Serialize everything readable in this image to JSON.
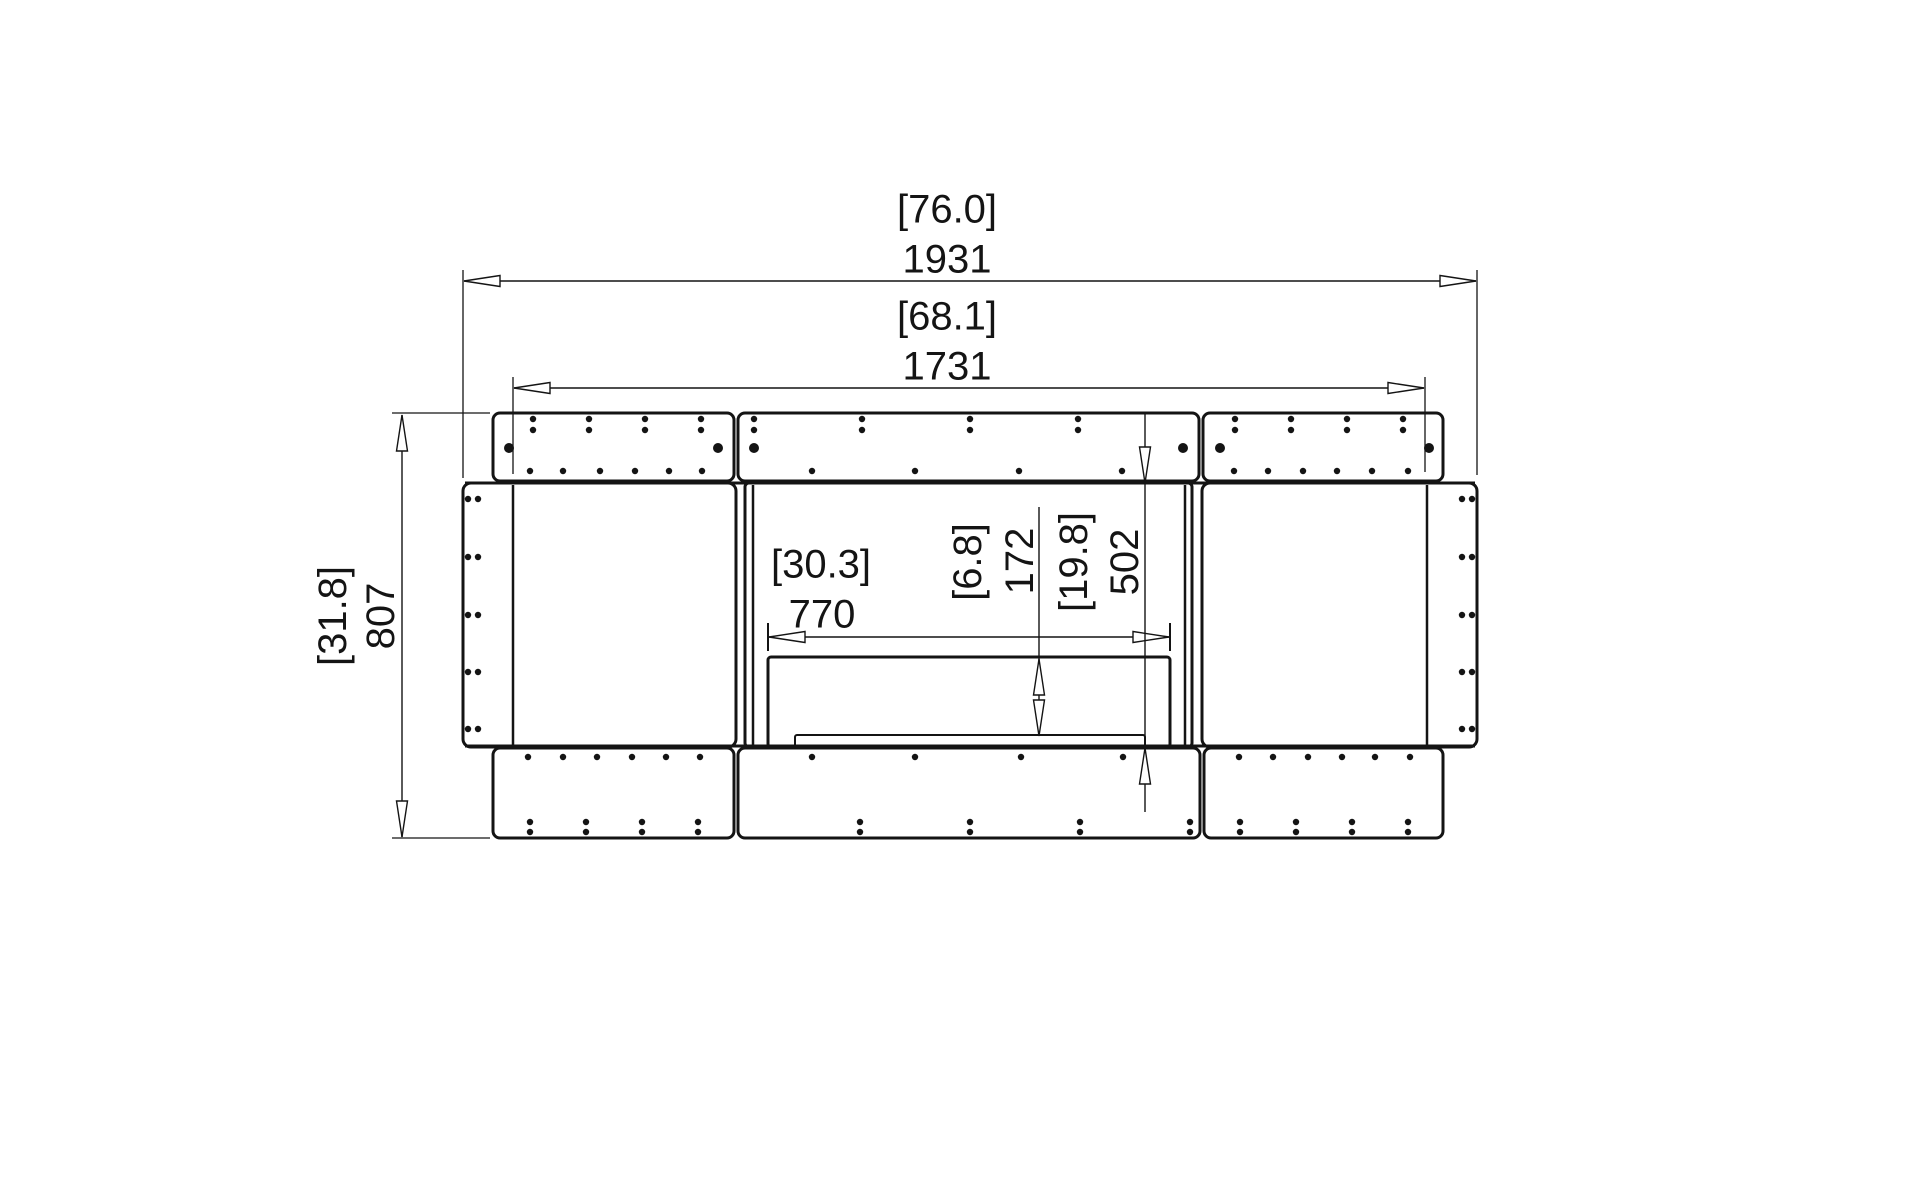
{
  "drawing": {
    "title": "fireplace-bench-front-elevation",
    "canvas": {
      "width": 1920,
      "height": 1187,
      "background": "#ffffff",
      "ink": "#141414"
    },
    "units_note_visible": false,
    "dimensions": [
      {
        "name": "overall-width",
        "inches": "[76.0]",
        "mm": "1931",
        "rotated": false,
        "line": {
          "x1": 464,
          "y1": 281,
          "x2": 1476,
          "y2": 281
        },
        "exts": [
          {
            "x1": 463,
            "y1": 270,
            "x2": 463,
            "y2": 478
          },
          {
            "x1": 1477,
            "y1": 270,
            "x2": 1477,
            "y2": 475
          }
        ],
        "ticks": [],
        "arrows": [
          {
            "x": 464,
            "y": 281,
            "dir": "left"
          },
          {
            "x": 1476,
            "y": 281,
            "dir": "right"
          }
        ],
        "labels": {
          "inches": {
            "x": 947,
            "y": 211
          },
          "mm": {
            "x": 947,
            "y": 261
          }
        }
      },
      {
        "name": "top-panel-width",
        "inches": "[68.1]",
        "mm": "1731",
        "rotated": false,
        "line": {
          "x1": 514,
          "y1": 388,
          "x2": 1424,
          "y2": 388
        },
        "exts": [
          {
            "x1": 513,
            "y1": 377,
            "x2": 513,
            "y2": 474
          },
          {
            "x1": 1425,
            "y1": 377,
            "x2": 1425,
            "y2": 472
          }
        ],
        "ticks": [],
        "arrows": [
          {
            "x": 514,
            "y": 388,
            "dir": "left"
          },
          {
            "x": 1424,
            "y": 388,
            "dir": "right"
          }
        ],
        "labels": {
          "inches": {
            "x": 947,
            "y": 318
          },
          "mm": {
            "x": 947,
            "y": 368
          }
        }
      },
      {
        "name": "overall-height",
        "inches": "[31.8]",
        "mm": "807",
        "rotated": true,
        "line": {
          "x1": 402,
          "y1": 415,
          "x2": 402,
          "y2": 837
        },
        "exts": [
          {
            "x1": 392,
            "y1": 413,
            "x2": 490,
            "y2": 413
          },
          {
            "x1": 392,
            "y1": 838,
            "x2": 490,
            "y2": 838
          }
        ],
        "ticks": [],
        "arrows": [
          {
            "x": 402,
            "y": 415,
            "dir": "up"
          },
          {
            "x": 402,
            "y": 837,
            "dir": "down"
          }
        ],
        "labels": {
          "inches": {
            "x": 333,
            "y": 616
          },
          "mm": {
            "x": 381,
            "y": 616
          }
        }
      },
      {
        "name": "burner-width",
        "inches": "[30.3]",
        "mm": "770",
        "rotated": false,
        "line": {
          "x1": 769,
          "y1": 637,
          "x2": 1169,
          "y2": 637
        },
        "exts": [],
        "ticks": [
          {
            "x1": 768,
            "y1": 623,
            "x2": 768,
            "y2": 651
          },
          {
            "x1": 1170,
            "y1": 623,
            "x2": 1170,
            "y2": 651
          }
        ],
        "arrows": [
          {
            "x": 769,
            "y": 637,
            "dir": "left"
          },
          {
            "x": 1169,
            "y": 637,
            "dir": "right"
          }
        ],
        "labels": {
          "inches": {
            "x": 821,
            "y": 566
          },
          "mm": {
            "x": 822,
            "y": 616
          }
        }
      },
      {
        "name": "burner-height",
        "inches": "[6.8]",
        "mm": "172",
        "rotated": true,
        "line": {
          "x1": 1039,
          "y1": 507,
          "x2": 1039,
          "y2": 736
        },
        "exts": [],
        "ticks": [],
        "arrows": [
          {
            "x": 1039,
            "y": 659,
            "dir": "up"
          },
          {
            "x": 1039,
            "y": 736,
            "dir": "down"
          }
        ],
        "labels": {
          "inches": {
            "x": 968,
            "y": 562
          },
          "mm": {
            "x": 1020,
            "y": 561
          }
        }
      },
      {
        "name": "opening-height",
        "inches": "[19.8]",
        "mm": "502",
        "rotated": true,
        "line": {
          "x1": 1145,
          "y1": 413,
          "x2": 1145,
          "y2": 812
        },
        "exts": [],
        "ticks": [],
        "arrows": [
          {
            "x": 1145,
            "y": 483,
            "dir": "down"
          },
          {
            "x": 1145,
            "y": 748,
            "dir": "up"
          }
        ],
        "labels": {
          "inches": {
            "x": 1074,
            "y": 562
          },
          "mm": {
            "x": 1125,
            "y": 562
          }
        }
      }
    ],
    "parts": [
      {
        "name": "top-panel-left",
        "x": 493,
        "y": 413,
        "w": 241,
        "h": 68,
        "rx": 7,
        "sw": 3
      },
      {
        "name": "top-panel-center",
        "x": 738,
        "y": 413,
        "w": 461,
        "h": 68,
        "rx": 7,
        "sw": 3
      },
      {
        "name": "top-panel-right",
        "x": 1203,
        "y": 413,
        "w": 240,
        "h": 68,
        "rx": 7,
        "sw": 3
      },
      {
        "name": "cabinet-left",
        "x": 463,
        "y": 483,
        "w": 273,
        "h": 264,
        "rx": 8,
        "sw": 3
      },
      {
        "name": "cabinet-right",
        "x": 1202,
        "y": 483,
        "w": 275,
        "h": 264,
        "rx": 8,
        "sw": 3
      },
      {
        "name": "firebox-module",
        "x": 745,
        "y": 483,
        "w": 447,
        "h": 264,
        "rx": 4,
        "sw": 3
      },
      {
        "name": "burner-box",
        "x": 768,
        "y": 657,
        "w": 402,
        "h": 90,
        "rx": 3,
        "sw": 3
      },
      {
        "name": "burner-tray",
        "x": 795,
        "y": 735,
        "w": 350,
        "h": 13,
        "rx": 2,
        "sw": 2
      },
      {
        "name": "base-panel-left",
        "x": 493,
        "y": 748,
        "w": 241,
        "h": 90,
        "rx": 7,
        "sw": 3
      },
      {
        "name": "base-panel-center",
        "x": 738,
        "y": 748,
        "w": 462,
        "h": 90,
        "rx": 7,
        "sw": 3
      },
      {
        "name": "base-panel-right",
        "x": 1204,
        "y": 748,
        "w": 239,
        "h": 90,
        "rx": 7,
        "sw": 3
      }
    ],
    "lines": [
      {
        "name": "body-top-edge",
        "x1": 465,
        "y1": 483,
        "x2": 1475,
        "y2": 483,
        "sw": 3
      },
      {
        "name": "body-bottom-edge",
        "x1": 465,
        "y1": 746,
        "x2": 1475,
        "y2": 746,
        "sw": 3
      },
      {
        "name": "stile-seam-left",
        "x1": 513,
        "y1": 485,
        "x2": 513,
        "y2": 745,
        "sw": 2.5
      },
      {
        "name": "stile-seam-right",
        "x1": 1427,
        "y1": 485,
        "x2": 1427,
        "y2": 745,
        "sw": 2.5
      },
      {
        "name": "firebox-wall-left-inner",
        "x1": 753,
        "y1": 485,
        "x2": 753,
        "y2": 745,
        "sw": 2.5
      },
      {
        "name": "firebox-wall-right-inner",
        "x1": 1185,
        "y1": 485,
        "x2": 1185,
        "y2": 745,
        "sw": 2.5
      }
    ],
    "dot_groups": [
      {
        "name": "top-strip-screw-pairs",
        "xs": [
          533,
          589,
          645,
          701,
          754,
          862,
          970,
          1078,
          1235,
          1291,
          1347,
          1403
        ],
        "ys": [
          419,
          430
        ],
        "r": 3.2
      },
      {
        "name": "top-strip-large-screws",
        "xs": [
          509,
          718,
          754,
          1183,
          1220,
          1429
        ],
        "ys": [
          448
        ],
        "r": 5
      },
      {
        "name": "top-strip-bottom-row",
        "xs": [
          530,
          563,
          600,
          635,
          669,
          702,
          812,
          915,
          1019,
          1122,
          1234,
          1268,
          1303,
          1337,
          1372,
          1408
        ],
        "ys": [
          471
        ],
        "r": 3.2
      },
      {
        "name": "base-strip-top-row",
        "xs": [
          528,
          563,
          597,
          632,
          666,
          700,
          812,
          915,
          1021,
          1123,
          1239,
          1273,
          1308,
          1342,
          1375,
          1410
        ],
        "ys": [
          757
        ],
        "r": 3.2
      },
      {
        "name": "base-strip-screw-pairs",
        "xs": [
          530,
          586,
          642,
          698,
          860,
          970,
          1080,
          1190,
          1240,
          1296,
          1352,
          1408
        ],
        "ys": [
          822,
          832
        ],
        "r": 3.2
      },
      {
        "name": "left-stile-screw-pairs",
        "xs": [
          468,
          478
        ],
        "ys": [
          499,
          557,
          615,
          672,
          729
        ],
        "r": 3.2
      },
      {
        "name": "right-stile-screw-pairs",
        "xs": [
          1462,
          1472
        ],
        "ys": [
          499,
          557,
          615,
          672,
          729
        ],
        "r": 3.2
      }
    ],
    "arrow_style": {
      "length": 36,
      "half_width": 5.5
    }
  }
}
